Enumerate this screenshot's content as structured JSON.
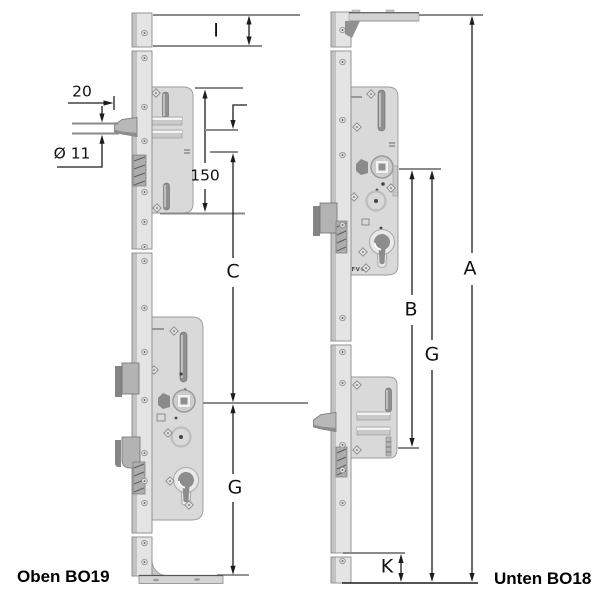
{
  "diagram": {
    "left_assembly": {
      "caption": "Oben BO19",
      "brand": "KFV®",
      "dimensions": {
        "top_extension": "I",
        "backset": "20",
        "latch_diameter": "Ø 11",
        "case_height": "150",
        "centre_distance": "C",
        "lower_distance": "G"
      }
    },
    "right_assembly": {
      "caption": "Unten BO18",
      "brand": "KFV®",
      "dimensions": {
        "total_length": "A",
        "upper_distance": "B",
        "lower_distance": "G",
        "bottom_extension": "K"
      }
    },
    "colors": {
      "background": "#ffffff",
      "metal_light": "#e4e4e4",
      "metal_mid": "#c9c9c9",
      "metal_dark": "#8f8f8f",
      "dimension_line": "#1c1c1c",
      "reference_line": "#8a8a8a",
      "text": "#111111"
    }
  }
}
